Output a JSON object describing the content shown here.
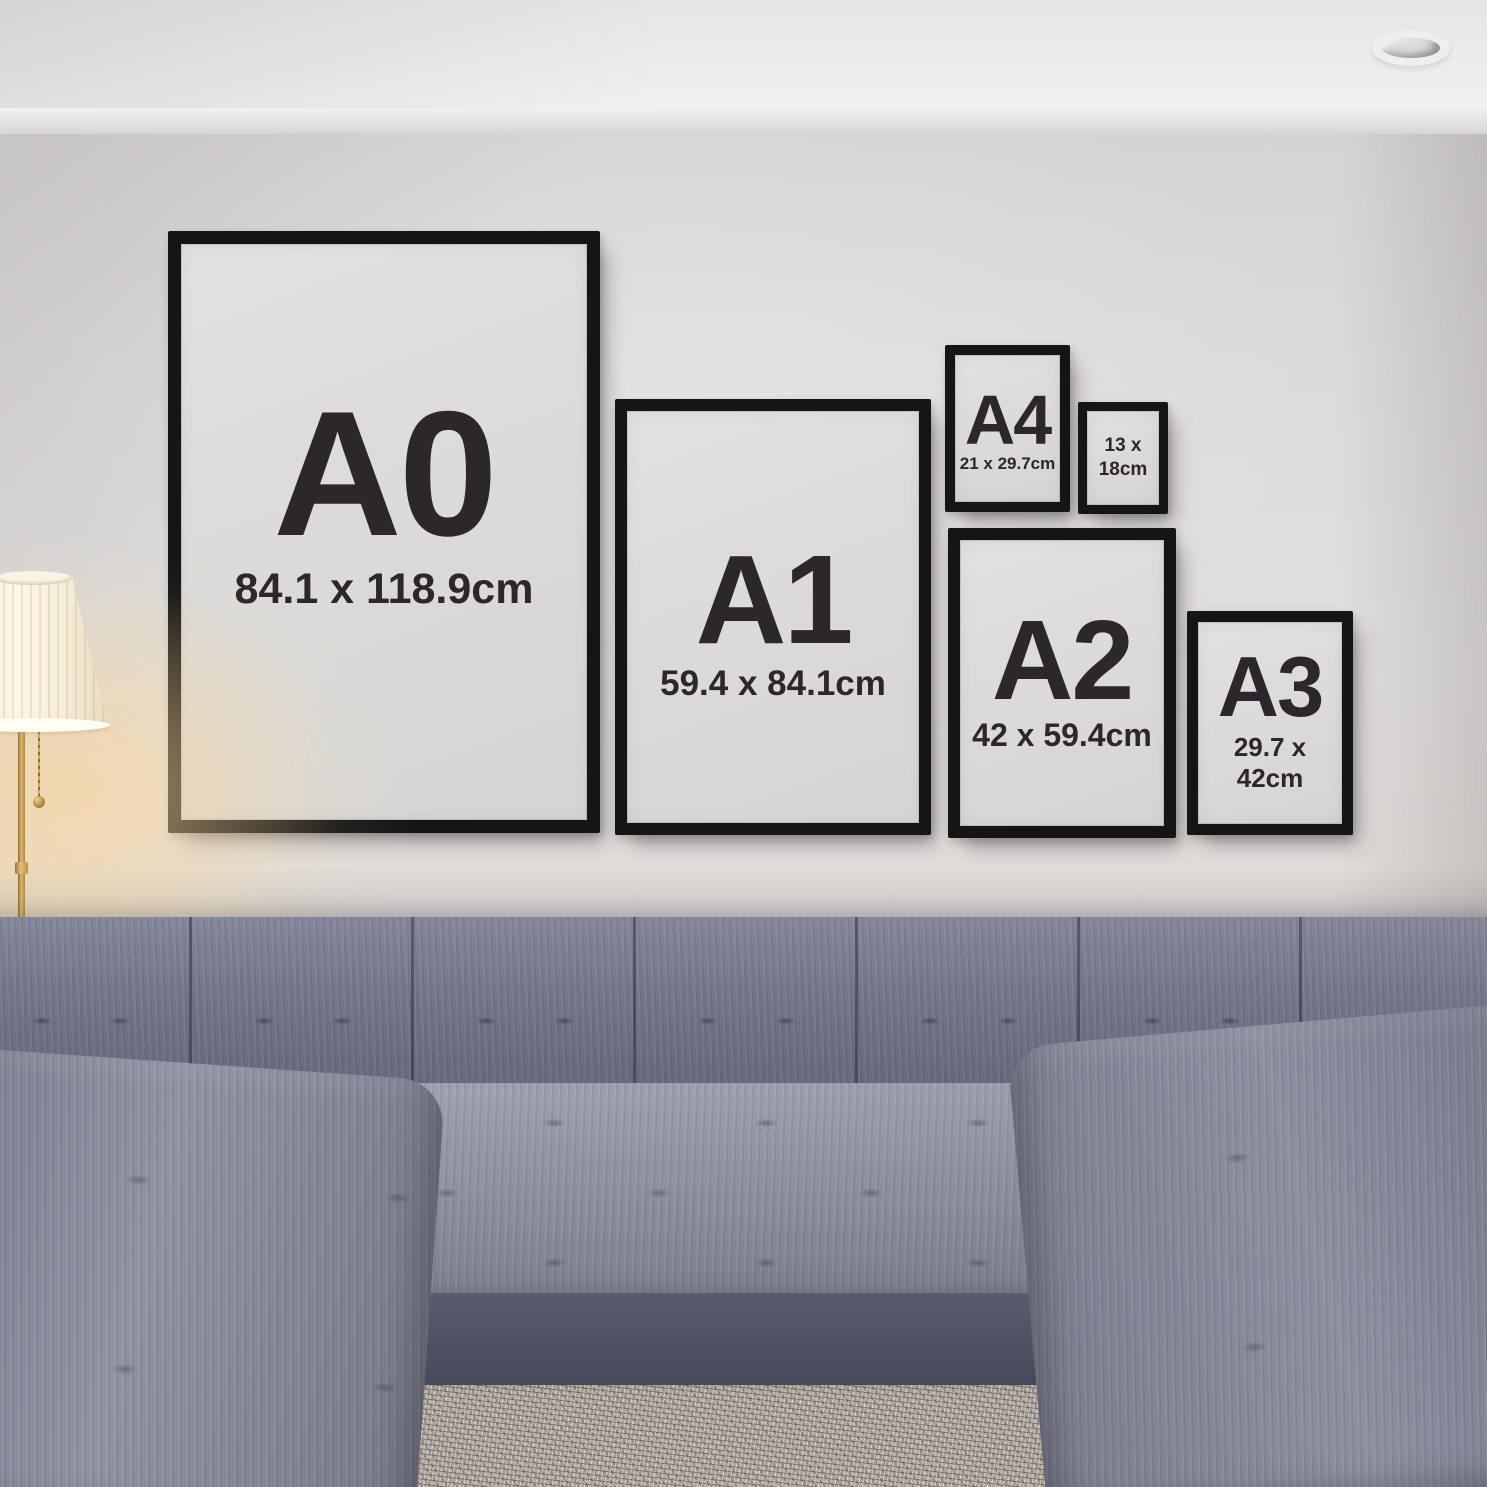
{
  "frames": [
    {
      "label": "A0",
      "size": "84.1 x 118.9cm"
    },
    {
      "label": "A1",
      "size": "59.4 x 84.1cm"
    },
    {
      "label": "A4",
      "size": "21 x 29.7cm"
    },
    {
      "label": "",
      "size": "13 x 18cm"
    },
    {
      "label": "A2",
      "size": "42 x 59.4cm"
    },
    {
      "label": "A3",
      "size": "29.7 x 42cm"
    }
  ],
  "colors": {
    "frame_black": "#151515",
    "poster_gray": "#dbdad8",
    "wall_gray": "#dcdad8",
    "ceiling_white": "#f2f1ef",
    "sofa_fabric": "#84869a",
    "sofa_shadow": "#474859",
    "rug_beige": "#aba59b",
    "floor_wood": "#4c2b20",
    "lamp_glow": "#ffd696",
    "lamp_shade": "#fdf8ea",
    "lamp_brass": "#dcb76e",
    "text_dark": "#2b272b"
  }
}
